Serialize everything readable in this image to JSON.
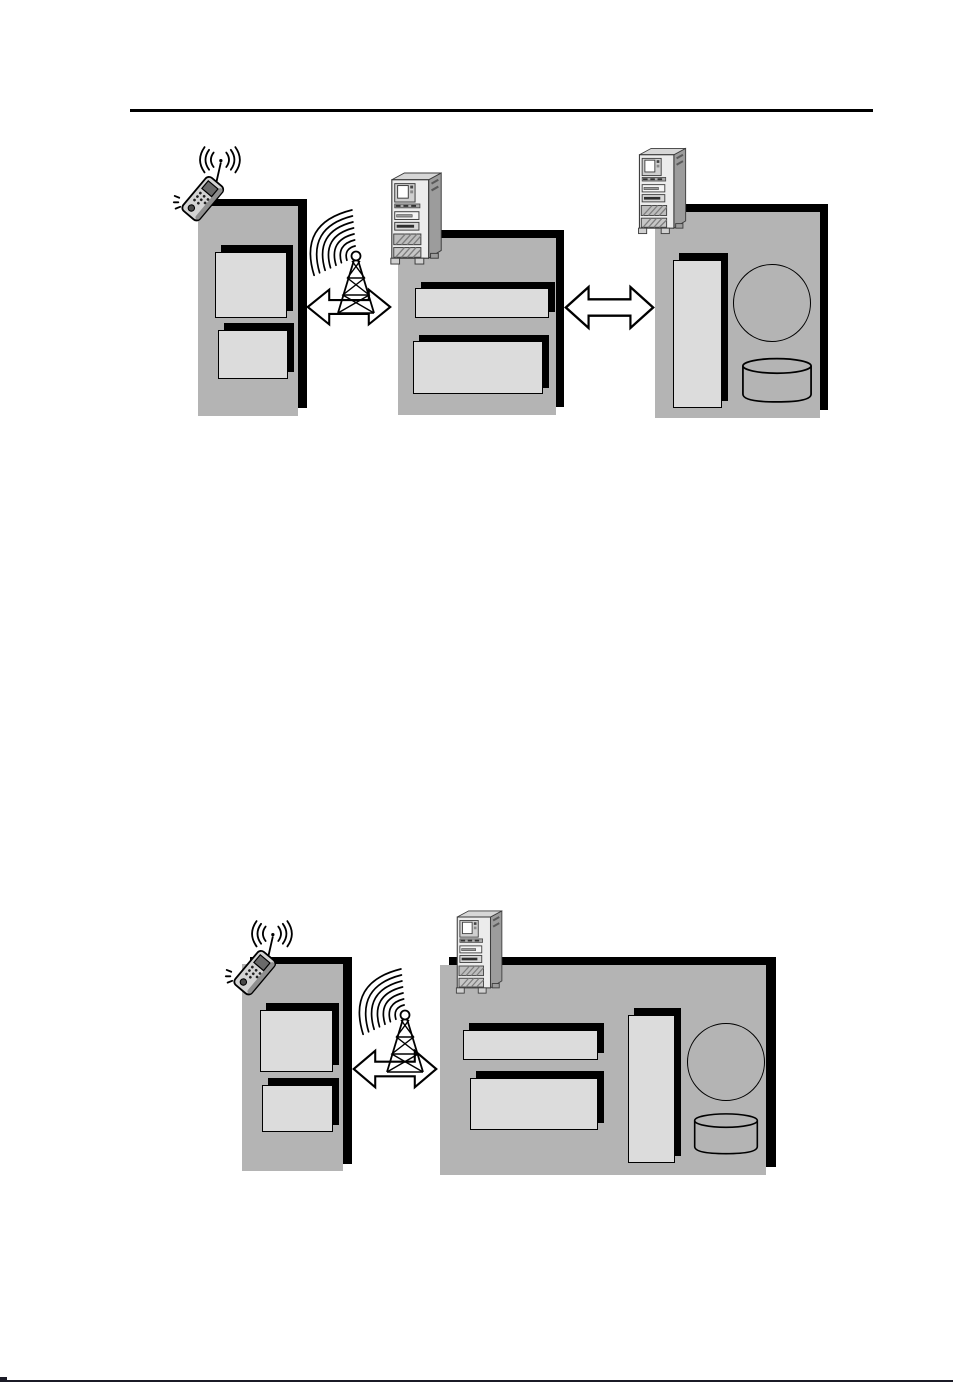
{
  "page": {
    "kind": "document-figure-page",
    "visible_text": "",
    "header_rule": {
      "present": true
    },
    "footer_rule": {
      "present": true
    }
  },
  "colors": {
    "page-bg": "#ffffff",
    "rule-color": "#000000",
    "footer-rule": "#1b1b26",
    "panel-fill": "#b4b4b4",
    "panel-shadow": "#000000",
    "module-fill": "#dcdcdc",
    "outline": "#000000",
    "arrow-fill": "#ffffff",
    "server-front": "#ececec",
    "server-side": "#9c9c9c",
    "phone-body": "#d4d4d4"
  },
  "figure_top": {
    "description": "three-node wireless architecture: mobile client panel, radio link, gateway panel, wired link, origin server panel",
    "left_panel": {
      "icon": "mobile-phone-icon",
      "module_boxes": 2
    },
    "middle_panel": {
      "icon": "server-tower-icon",
      "module_boxes": 2
    },
    "right_panel": {
      "icon": "server-tower-icon",
      "module_boxes": 1,
      "process_circle": true,
      "database_cylinder": true
    },
    "link_1": {
      "type": "radio",
      "icons": [
        "radio-tower-icon",
        "bidirectional-arrow-icon"
      ]
    },
    "link_2": {
      "type": "wired",
      "icons": [
        "bidirectional-arrow-icon"
      ]
    }
  },
  "figure_bottom": {
    "description": "two-node wireless architecture: mobile client panel, radio link, combined server panel",
    "left_panel": {
      "icon": "mobile-phone-icon",
      "module_boxes": 2
    },
    "right_panel": {
      "icon": "server-tower-icon",
      "module_boxes": 3,
      "process_circle": true,
      "database_cylinder": true
    },
    "link_1": {
      "type": "radio",
      "icons": [
        "radio-tower-icon",
        "bidirectional-arrow-icon"
      ]
    }
  }
}
